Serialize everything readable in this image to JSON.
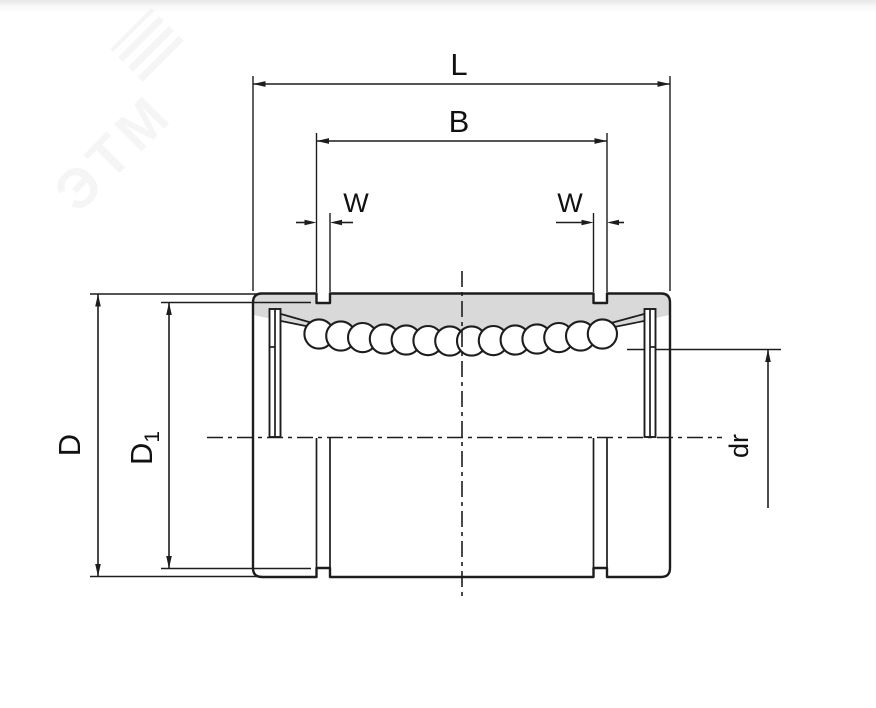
{
  "figure": {
    "type": "technical-drawing",
    "subject": "linear ball bearing half-section",
    "ball_count": 14,
    "colors": {
      "line": "#1d1d1d",
      "section_fill": "#d9d9d9",
      "background": "#ffffff"
    }
  },
  "watermark": {
    "text": "ЭТМ"
  },
  "dimensions": {
    "overall_length": "L",
    "ring_groove_span": "B",
    "groove_width_left": "W",
    "groove_width_right": "W",
    "outer_diameter": "D",
    "groove_diameter_base": "D",
    "groove_diameter_subscript": "1",
    "bore_diameter": "dr"
  }
}
